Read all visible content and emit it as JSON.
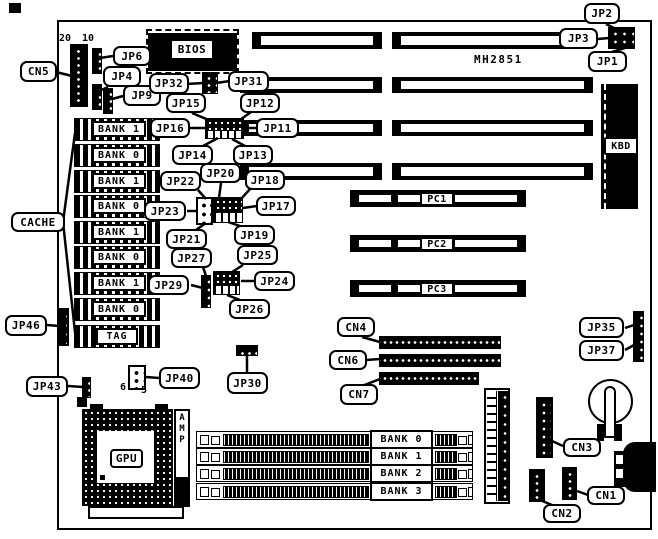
{
  "board": {
    "model": "MH2851"
  },
  "labels": {
    "cn5": "CN5",
    "jp6": "JP6",
    "jp4": "JP4",
    "jp9": "JP9",
    "bios": "BIOS",
    "jp32": "JP32",
    "jp31": "JP31",
    "jp15": "JP15",
    "jp12": "JP12",
    "jp16": "JP16",
    "jp11": "JP11",
    "jp14": "JP14",
    "jp13": "JP13",
    "jp22": "JP22",
    "jp20": "JP20",
    "jp18": "JP18",
    "jp23": "JP23",
    "jp17": "JP17",
    "jp21": "JP21",
    "jp19": "JP19",
    "jp27": "JP27",
    "jp25": "JP25",
    "jp29": "JP29",
    "jp24": "JP24",
    "jp26": "JP26",
    "cache": "CACHE",
    "jp46": "JP46",
    "jp43": "JP43",
    "jp40": "JP40",
    "jp30": "JP30",
    "jp2": "JP2",
    "jp3": "JP3",
    "jp1": "JP1",
    "jp35": "JP35",
    "jp37": "JP37",
    "cn4": "CN4",
    "cn6": "CN6",
    "cn7": "CN7",
    "cn3": "CN3",
    "cn2": "CN2",
    "cn1": "CN1",
    "kbd": "KBD",
    "cpu_socket": "GPU",
    "amp": "AMP",
    "tag": "TAG"
  },
  "pin_numbers": {
    "cn5_pin20": "20",
    "cn5_pin10": "10",
    "jp40_pin6": "6",
    "jp40_pin5": "5"
  },
  "cache_banks": [
    "BANK 1",
    "BANK 0",
    "BANK 1",
    "BANK 0",
    "BANK 1",
    "BANK 0",
    "BANK 1",
    "BANK 0"
  ],
  "memory_banks": [
    "BANK 0",
    "BANK 1",
    "BANK 2",
    "BANK 3"
  ],
  "pc_slots": [
    "PC1",
    "PC2",
    "PC3"
  ],
  "colors": {
    "ink": "#000000",
    "paper": "#ffffff"
  }
}
